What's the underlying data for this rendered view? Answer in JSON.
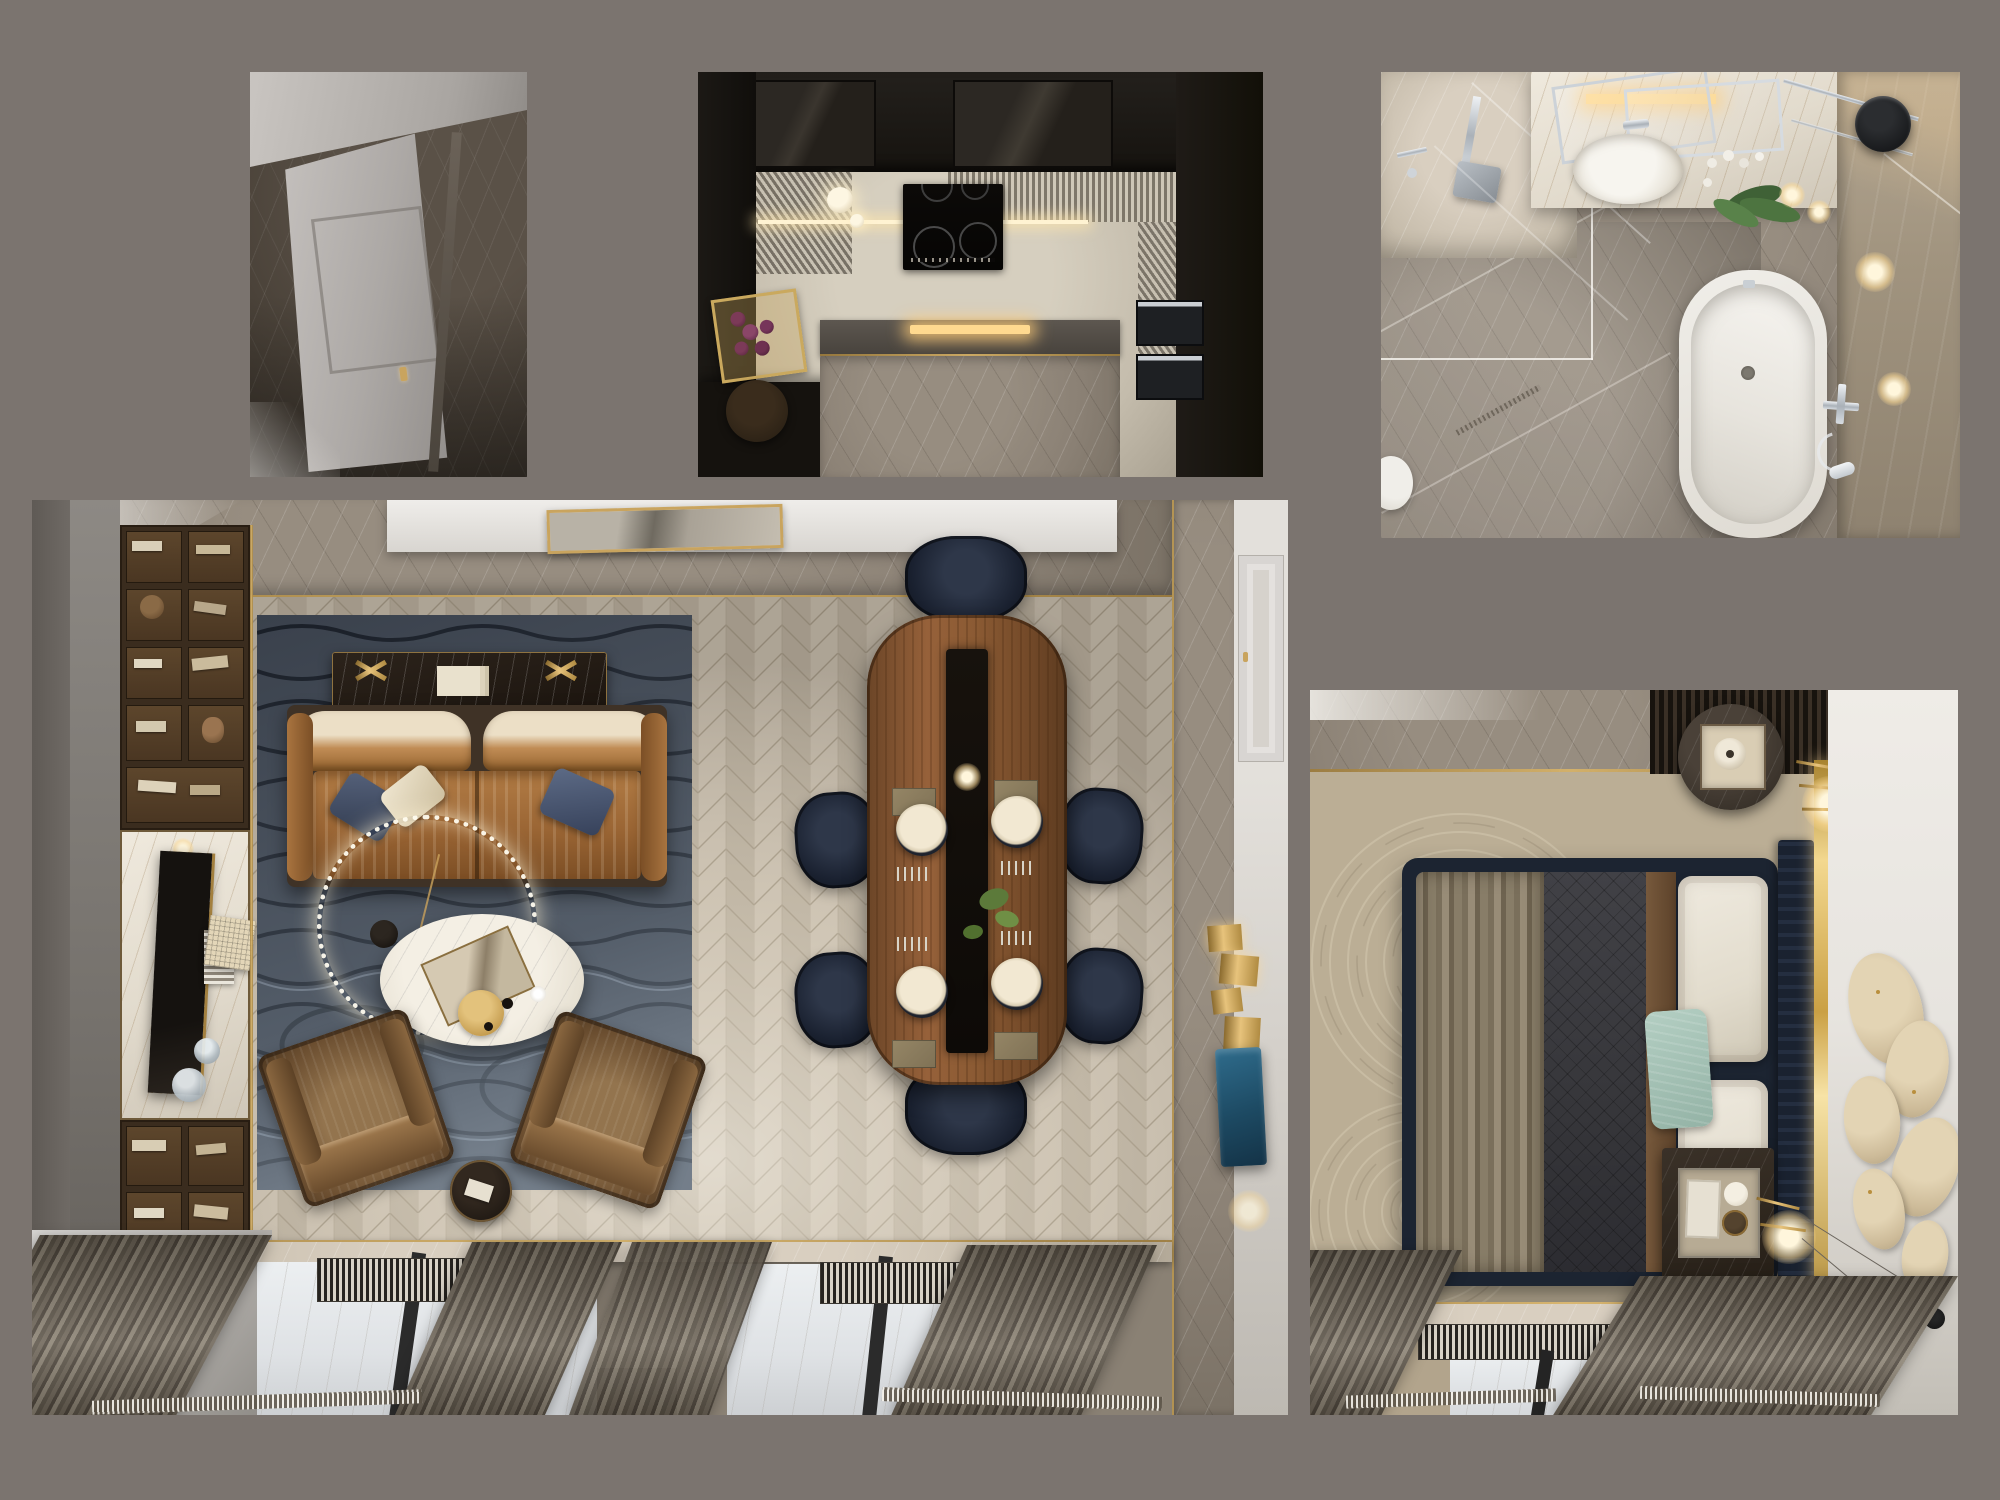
{
  "scene": {
    "title": "Apartment interior — top-down 3D render collage",
    "background_color": "#7b746f",
    "render_views": [
      {
        "id": "entry-hall",
        "label": "Entry hall — top view",
        "position": "top-left",
        "objects": [
          "paneled entry door with brass handle",
          "dark brown marble floor",
          "light gray wall band"
        ]
      },
      {
        "id": "kitchen",
        "label": "Kitchen — top view",
        "position": "top-center",
        "objects": [
          "dark wood perimeter cabinetry",
          "induction cooktop with 4 zones",
          "2 cream pendant lights",
          "gray marble island",
          "double wall ovens",
          "gold tray with grapes",
          "louvered slatted ceiling panels",
          "warm under-cabinet light strip"
        ]
      },
      {
        "id": "bathroom",
        "label": "Bathroom — top view",
        "position": "top-right",
        "objects": [
          "walk-in shower with glass screen",
          "rain shower head",
          "oval countertop basin with chrome mixer",
          "tilted chrome mirror frames",
          "backlit gold niche",
          "white orchid plant",
          "two candles",
          "freestanding white bathtub",
          "chrome bath mixer with hand shower",
          "black vessel",
          "gray marble floor tiles",
          "linear floor drain"
        ]
      },
      {
        "id": "living-dining",
        "label": "Living and dining room — top view",
        "position": "bottom-left",
        "objects": [
          "dark wood bookshelf wall unit with books",
          "white marble media niche with TV",
          "glass decanters",
          "woven cream box",
          "wave-pattern navy area rug",
          "black marble console with gold decor and book stack",
          "caramel velvet sofa with navy and cream pillows",
          "crystal ring chandelier",
          "white oval coffee table with gold tray and art book",
          "two brown velvet armchairs",
          "round black side table",
          "oval walnut dining table with dark runner",
          "six navy dining chairs",
          "four place settings with chargers and cutlery",
          "candle and greenery centerpiece",
          "gold framed painting on top wall",
          "gray marble wall bands with gold trim",
          "paneled side door",
          "gold relief wall art",
          "teal textile wall art",
          "two window bays with slatted radiator grilles",
          "dark window mullions",
          "taupe curtains",
          "black marble floor block"
        ]
      },
      {
        "id": "bedroom",
        "label": "Bedroom — top view",
        "position": "bottom-right",
        "objects": [
          "upholstered navy bed",
          "charcoal quilted duvet",
          "taupe pleated throw",
          "brown runner band",
          "two white stitched pillows",
          "teal accent pillow",
          "navy pleated headboard",
          "bright gold trim strip",
          "round marble nightstand with tray and lamp",
          "rectangular marble nightstand with decor tray and cups",
          "brass stick lamps with glow",
          "three black disc wall ornaments on wires",
          "beige leaf wall art on white wall",
          "swirl-pattern beige carpet",
          "gray marble entry strip with gold inlay",
          "window with slatted radiator grille",
          "dark window mullion",
          "taupe curtains",
          "black marble floor block"
        ]
      }
    ],
    "palette": {
      "canvas_gray": "#7b746f",
      "herringbone_floor": "#c2b8a7",
      "rug_navy": "#3a414c",
      "sofa_caramel": "#a06a38",
      "armchair_brown": "#6b4e30",
      "dining_walnut": "#8a5f3c",
      "chair_navy": "#1a2130",
      "gold_accent": "#c9a45e",
      "marble_gray": "#8b8175",
      "marble_dark": "#473f36",
      "bed_navy": "#1c2431",
      "duvet_charcoal": "#3a3a3e",
      "throw_taupe": "#8d8270",
      "pillow_teal": "#a9c6ba",
      "carpet_beige": "#b2a48c",
      "tub_white": "#ebe8e2",
      "cabinet_dark": "#1a1714"
    }
  }
}
